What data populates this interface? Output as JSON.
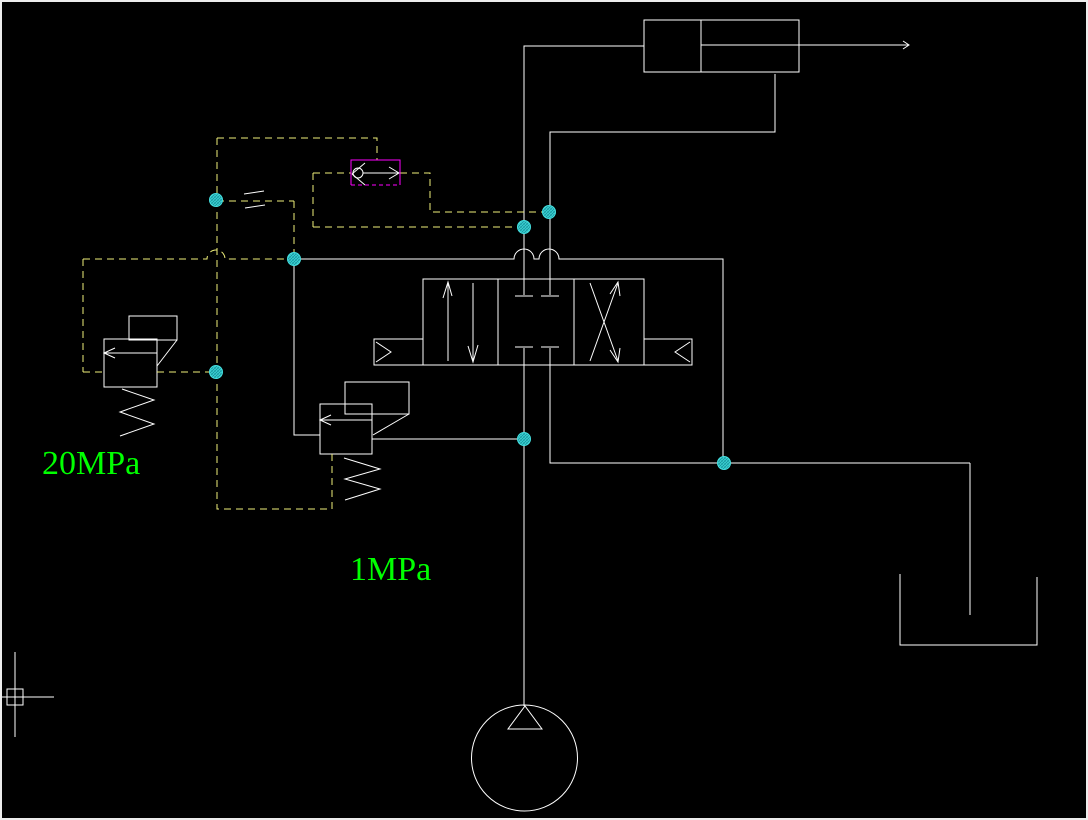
{
  "window": {
    "kind": "cad-viewport",
    "background": "#000000",
    "frame_color": "#ededed"
  },
  "colors": {
    "solid_line": "#ffffff",
    "pilot_dashed_line": "#f0f07a",
    "selection_box": "#ff00ff",
    "grip_fill": "#45e0e0",
    "grip_hatch": "#1a9aa2",
    "label_green": "#00ff00"
  },
  "labels": {
    "high_pressure_relief": "20MPa",
    "low_pressure_relief": "1MPa"
  },
  "components": [
    {
      "name": "hydraulic-cylinder"
    },
    {
      "name": "directional-valve-4-3"
    },
    {
      "name": "relief-valve-20mpa"
    },
    {
      "name": "relief-valve-1mpa"
    },
    {
      "name": "pilot-check-valve-selected"
    },
    {
      "name": "throttle-orifice"
    },
    {
      "name": "hydraulic-pump"
    },
    {
      "name": "tank"
    },
    {
      "name": "crosshair-cursor"
    }
  ]
}
